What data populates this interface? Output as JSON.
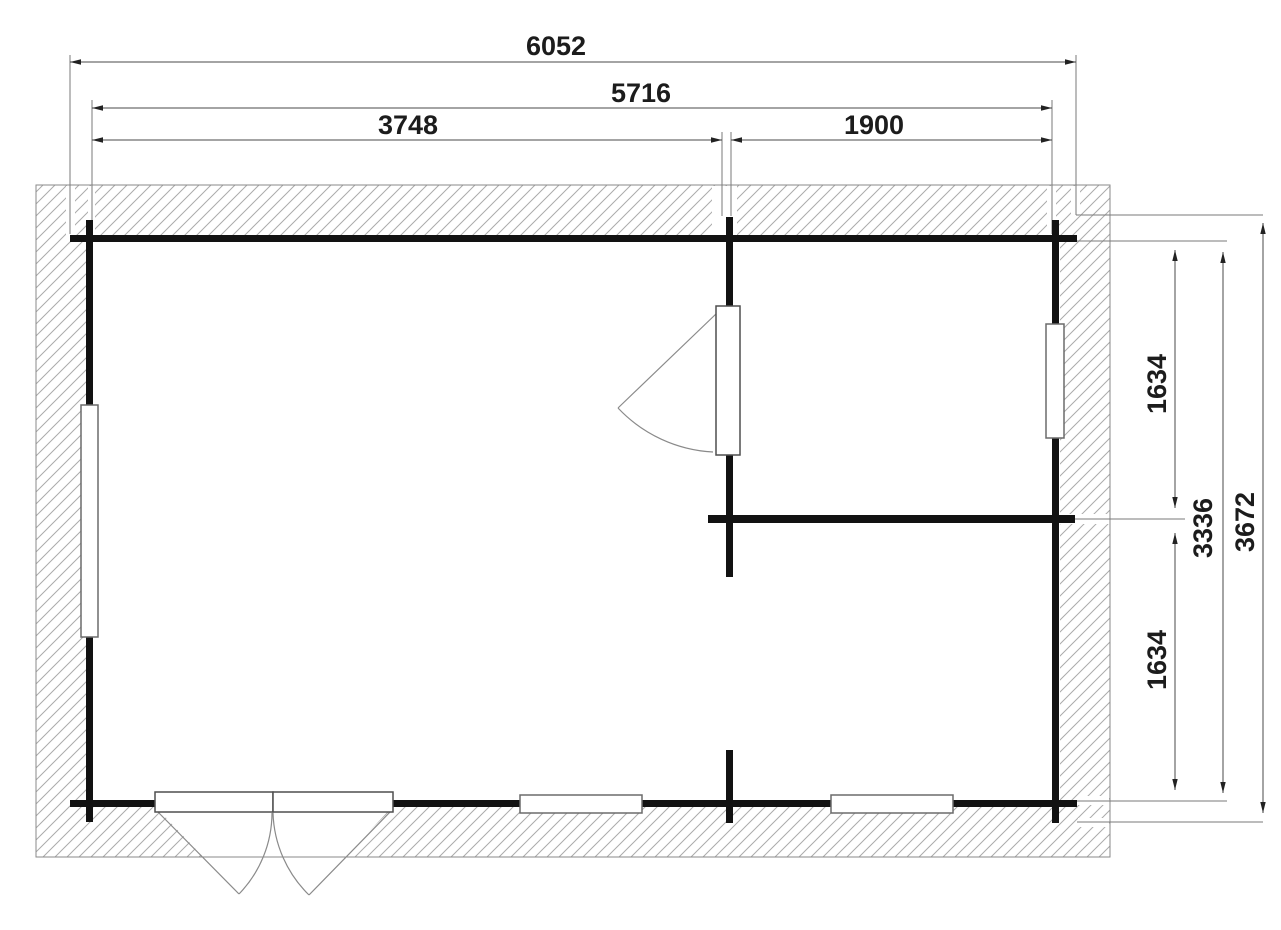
{
  "plan": {
    "type": "floor-plan",
    "colors": {
      "wall": "#121212",
      "dimension_line": "#4a4a4a",
      "extension_line": "#7a7a7a",
      "hatch_line": "#ababab",
      "band_outline": "#8a8a8a",
      "text": "#1c1c1c",
      "background": "#ffffff"
    },
    "dimensions": {
      "top": [
        {
          "name": "overall-width",
          "value": "6052"
        },
        {
          "name": "wall-outer-width",
          "value": "5716"
        },
        {
          "name": "left-room-width",
          "value": "3748"
        },
        {
          "name": "right-room-width",
          "value": "1900"
        }
      ],
      "right": [
        {
          "name": "upper-right-room-depth",
          "value": "1634"
        },
        {
          "name": "right-rooms-span",
          "value": "3336"
        },
        {
          "name": "overall-depth",
          "value": "3672"
        },
        {
          "name": "lower-right-room-depth",
          "value": "1634"
        }
      ]
    }
  }
}
